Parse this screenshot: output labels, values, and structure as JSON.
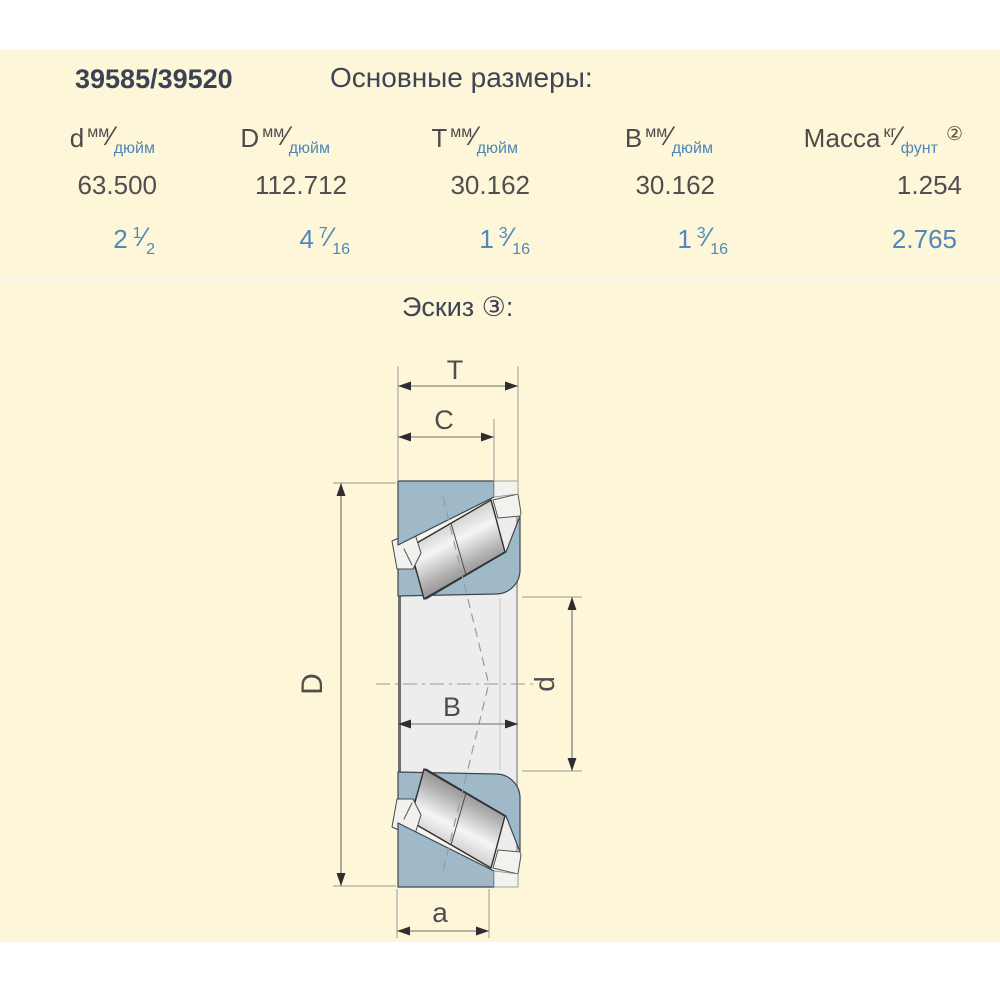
{
  "header": {
    "part_number": "39585/39520",
    "section_title": "Основные размеры:"
  },
  "table": {
    "columns": [
      {
        "symbol": "d",
        "unit_top": "мм",
        "unit_slash": "⁄",
        "unit_bottom": "дюйм",
        "footnote": ""
      },
      {
        "symbol": "D",
        "unit_top": "мм",
        "unit_slash": "⁄",
        "unit_bottom": "дюйм",
        "footnote": ""
      },
      {
        "symbol": "T",
        "unit_top": "мм",
        "unit_slash": "⁄",
        "unit_bottom": "дюйм",
        "footnote": ""
      },
      {
        "symbol": "B",
        "unit_top": "мм",
        "unit_slash": "⁄",
        "unit_bottom": "дюйм",
        "footnote": ""
      },
      {
        "symbol": "Масса",
        "unit_top": "кг",
        "unit_slash": "⁄",
        "unit_bottom": "фунт",
        "footnote": "②"
      }
    ],
    "metric_row": [
      "63.500",
      "112.712",
      "30.162",
      "30.162",
      "1.254"
    ],
    "inch_row": [
      {
        "int": "2",
        "num": "1",
        "slash": "⁄",
        "den": "2"
      },
      {
        "int": "4",
        "num": "7",
        "slash": "⁄",
        "den": "16"
      },
      {
        "int": "1",
        "num": "3",
        "slash": "⁄",
        "den": "16"
      },
      {
        "int": "1",
        "num": "3",
        "slash": "⁄",
        "den": "16"
      },
      {
        "int": "2.765",
        "num": "",
        "slash": "",
        "den": ""
      }
    ]
  },
  "sketch": {
    "title": "Эскиз ③:",
    "labels": {
      "T": "T",
      "C": "C",
      "D": "D",
      "B": "B",
      "d": "d",
      "a": "a"
    }
  },
  "colors": {
    "panel_bg": "#fdf6d8",
    "page_bg": "#ffffff",
    "metric_text": "#4f4f4f",
    "inch_text": "#4e89ba",
    "header_text": "#4c4c4c",
    "unit_blue": "#4d86b8",
    "title_text": "#3d4454",
    "part_number_text": "#3a4254",
    "ring_blue": "#9fb9c8",
    "outline": "#3e464e",
    "dim_line": "#6e6e6e",
    "ext_line": "#9a9a9a",
    "band_gray": "#ededed",
    "divider": "#f7f6ee"
  }
}
